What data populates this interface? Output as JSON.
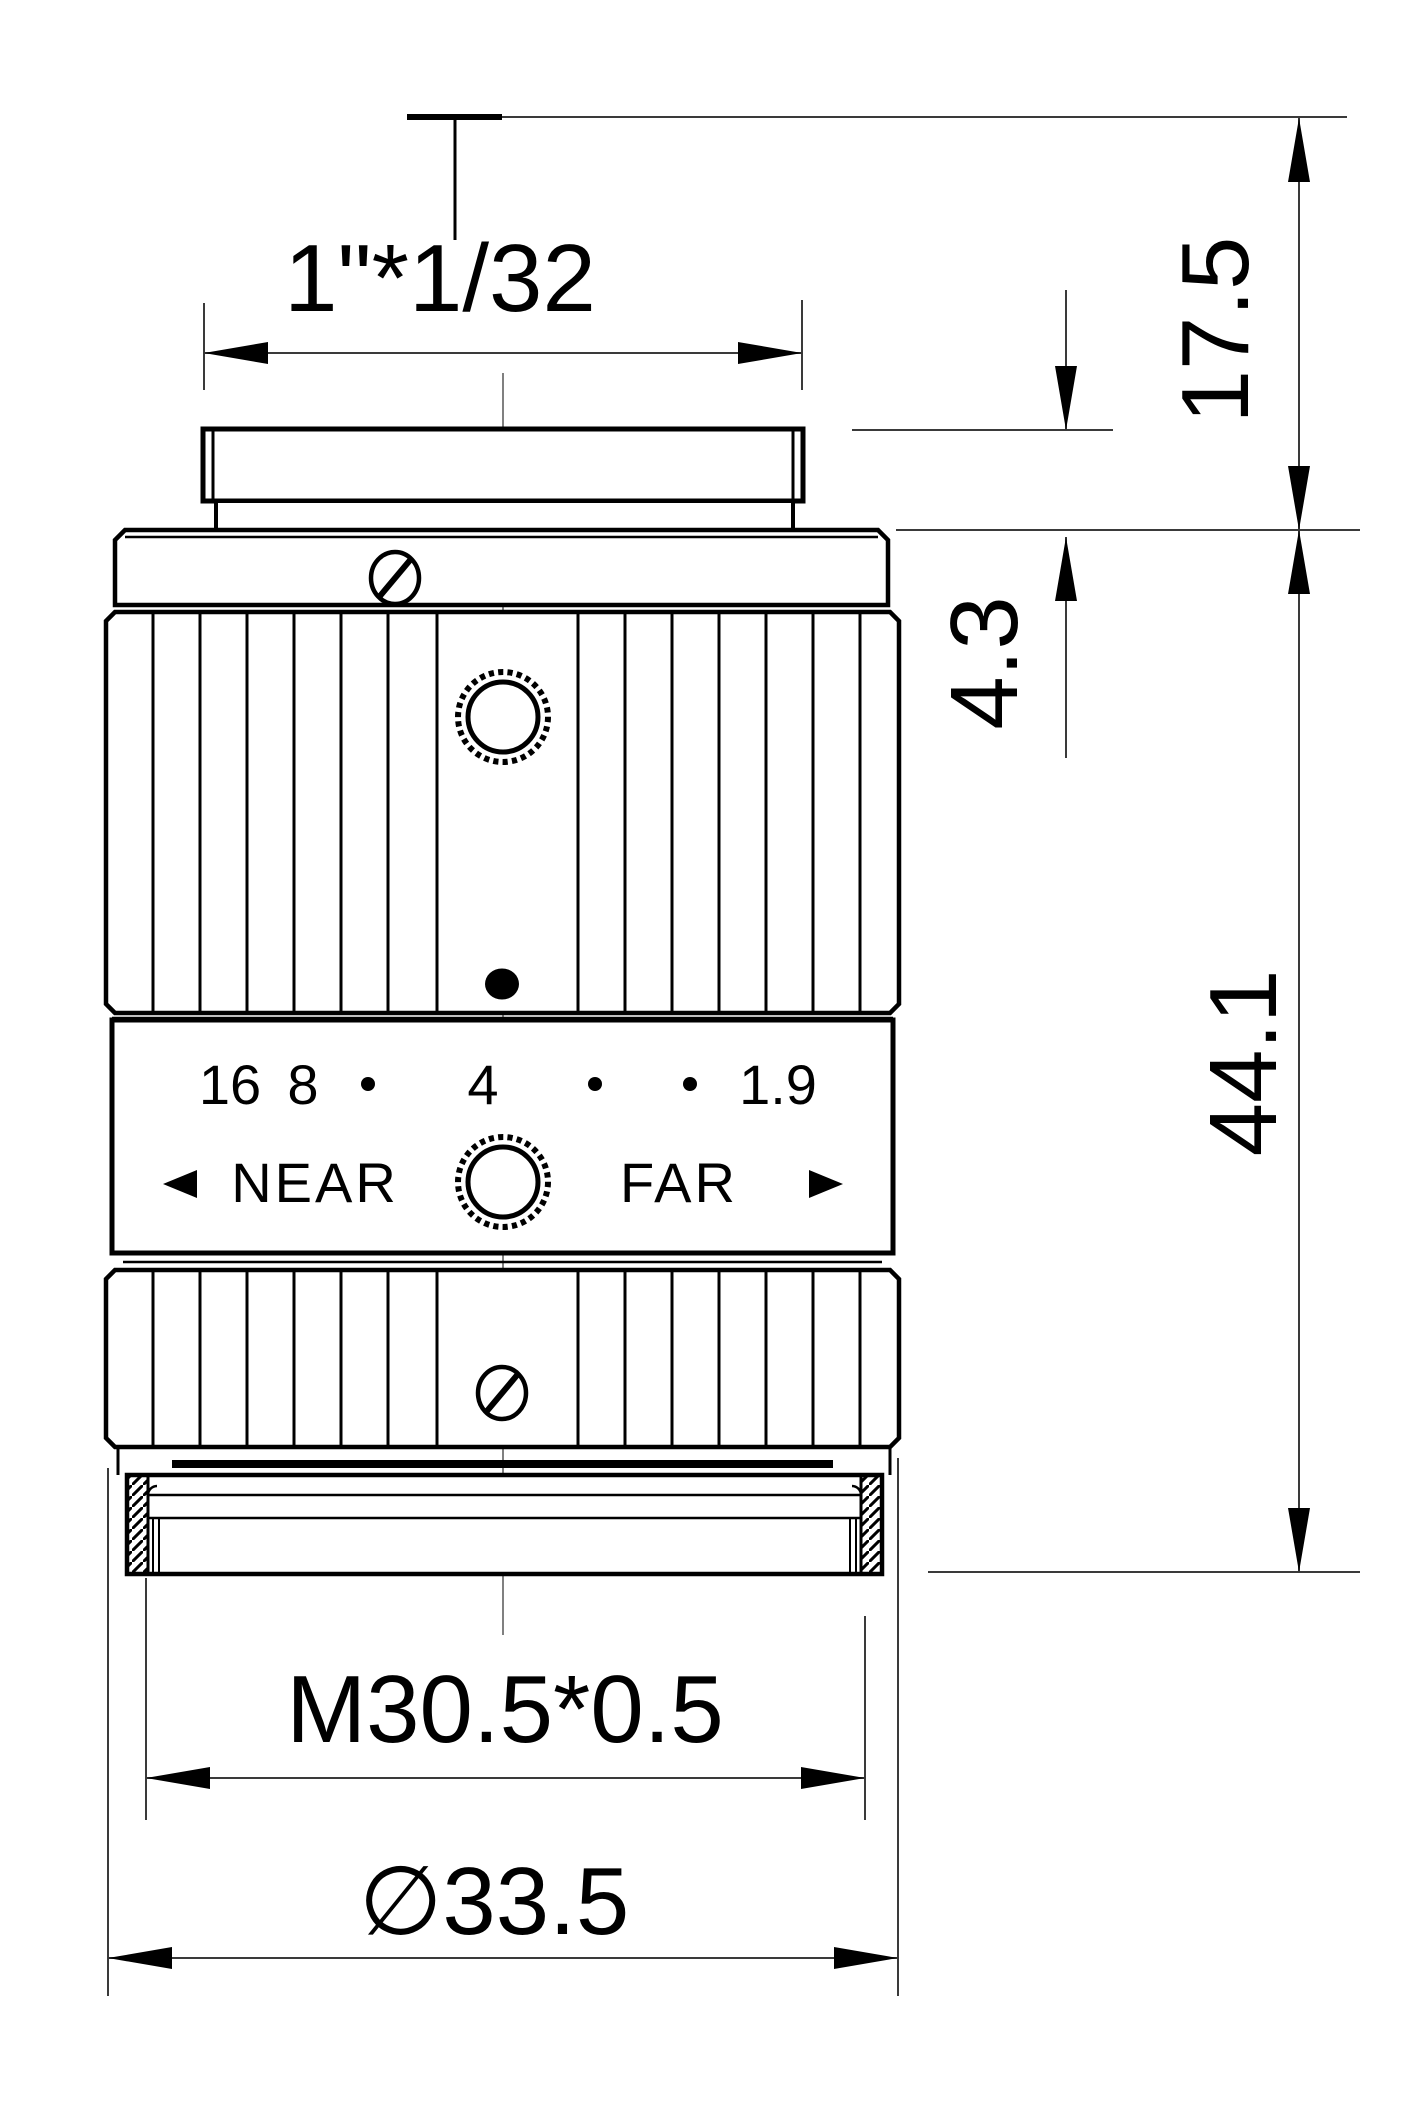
{
  "drawing_title": "lens-outline-drawing",
  "labels": {
    "top_thread": "1\"*1/32",
    "dim_top_height": "17.5",
    "dim_mid_height": "4.3",
    "dim_total_height": "44.1",
    "aperture_f16": "16",
    "aperture_f8": "8",
    "aperture_f4": "4",
    "aperture_f1_9": "1.9",
    "focus_near": "NEAR",
    "focus_far": "FAR",
    "bottom_thread": "M30.5*0.5",
    "bottom_diameter": "∅33.5"
  },
  "colors": {
    "outline": "#000000",
    "dimension_lines": "#3a3a3a",
    "centerline": "#808080",
    "background": "#ffffff"
  }
}
